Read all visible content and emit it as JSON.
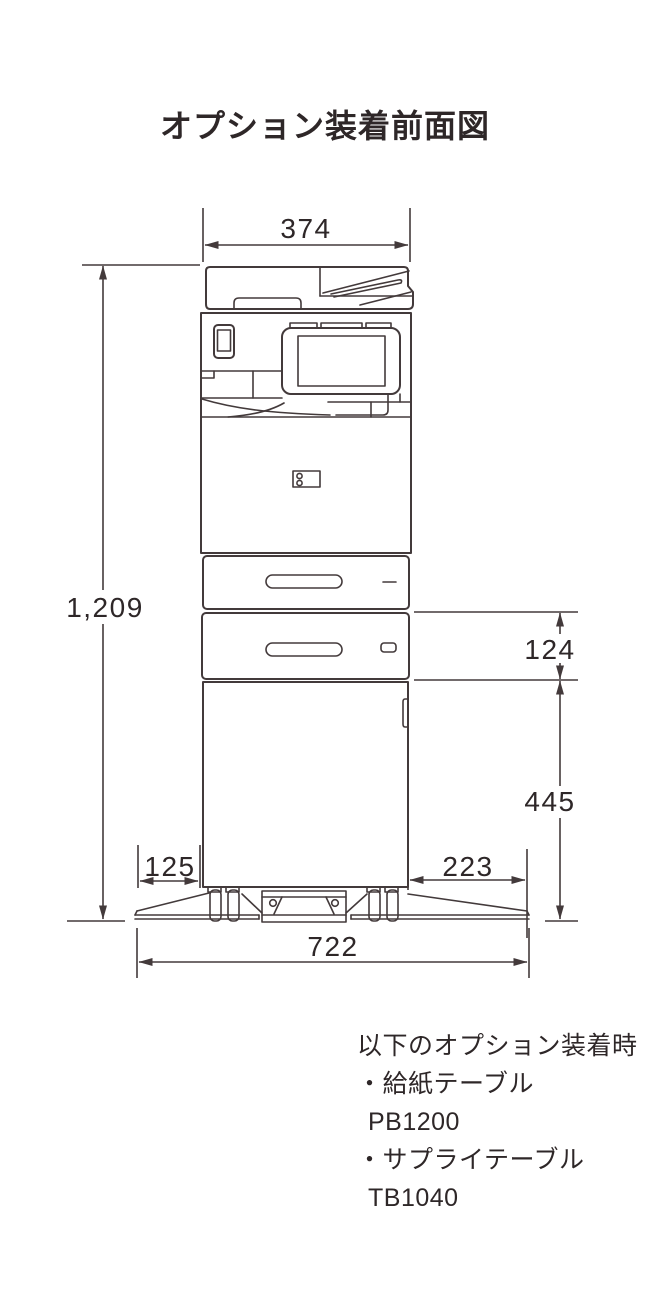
{
  "title": "オプション装着前面図",
  "dimensions": {
    "top_width": "374",
    "total_height": "1,209",
    "feed_table_height": "124",
    "supply_table_height": "445",
    "left_foot": "125",
    "right_foot": "223",
    "total_width": "722"
  },
  "notes": {
    "heading": "以下のオプション装着時",
    "items": [
      {
        "label": "・給紙テーブル",
        "model": "PB1200"
      },
      {
        "label": "・サプライテーブル",
        "model": "TB1040"
      }
    ]
  },
  "colors": {
    "line": "#433a3b",
    "text": "#2e2728"
  }
}
